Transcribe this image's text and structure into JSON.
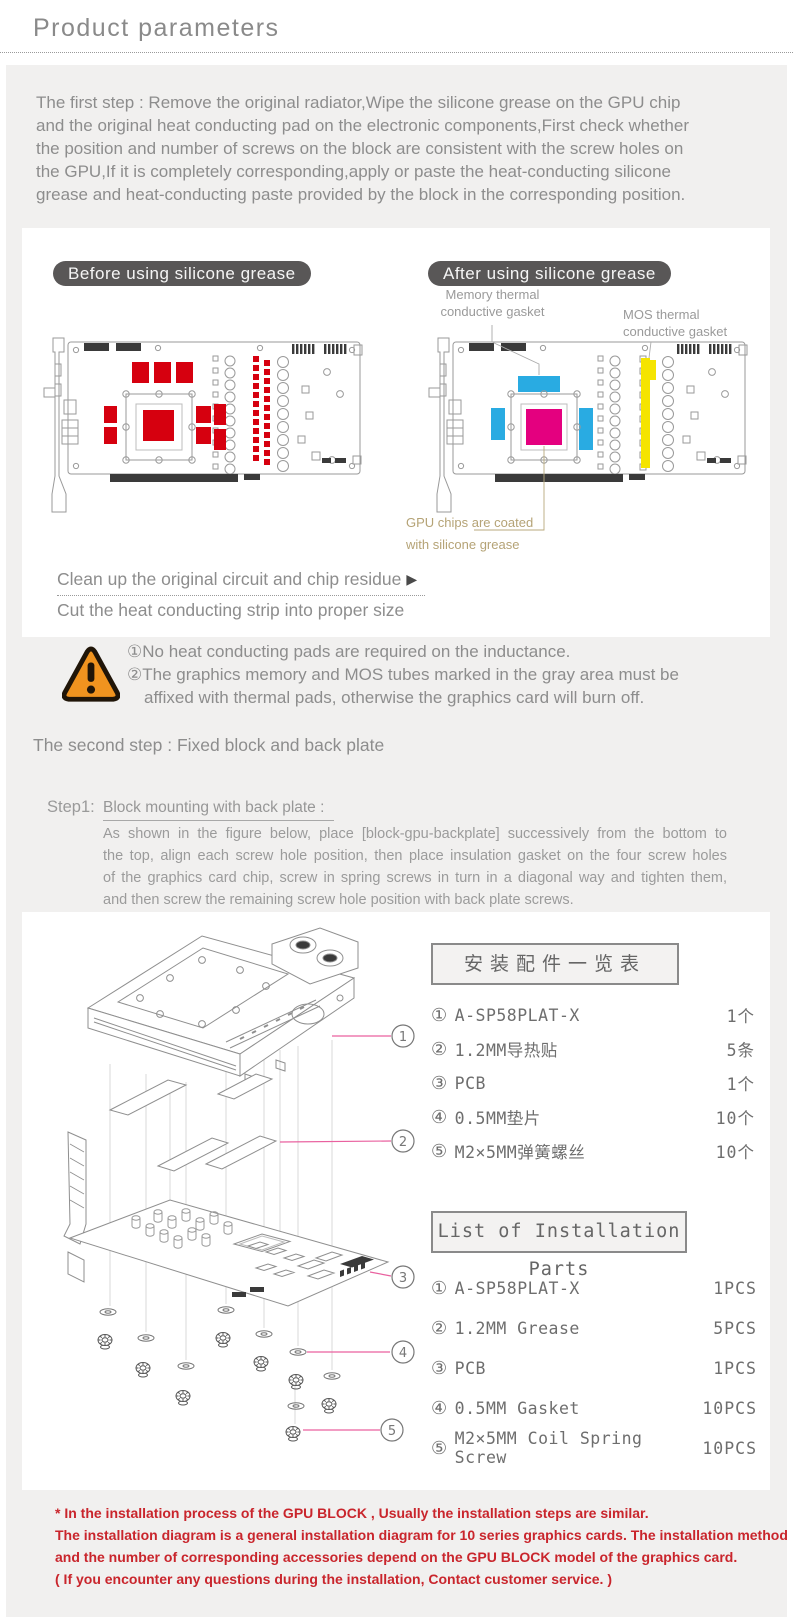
{
  "page": {
    "title": "Product parameters"
  },
  "intro": {
    "lines": [
      "The first step : Remove the original radiator,Wipe the silicone grease on the GPU chip",
      "and the original heat conducting pad on the electronic components,First check whether",
      "the position and number of screws on the block are consistent with the screw holes on",
      "the GPU,If it is completely corresponding,apply or paste the heat-conducting silicone",
      "grease and heat-conducting paste provided by the block in the corresponding position."
    ]
  },
  "grease_section": {
    "before_label": "Before using silicone grease",
    "after_label": "After using silicone grease",
    "memory_label": "Memory thermal conductive gasket",
    "mos_label": "MOS thermal conductive gasket",
    "gpu_label": "GPU chips are coated with silicone grease",
    "clean_line": "Clean up the original circuit and chip residue",
    "arrow": "▶",
    "cut_line": "Cut the heat conducting strip into proper size"
  },
  "warning": {
    "line1": "①No heat conducting pads are required on the inductance.",
    "line2": "②The graphics memory and MOS tubes marked in the gray area must be",
    "line3": "affixed with thermal pads, otherwise the graphics card will burn off."
  },
  "second_step": {
    "heading": "The second step : Fixed block and back plate",
    "step_label": "Step1:",
    "subheading": "Block mounting with back plate : ",
    "body_lines": [
      "As shown in the figure below, place [block-gpu-backplate] successively from the bottom to",
      "the top, align each screw hole position, then place insulation gasket on the four screw holes",
      "of the graphics card chip, screw in spring screws in turn in a diagonal way and tighten them,",
      "and then screw the remaining screw hole position with back plate screws."
    ]
  },
  "callouts": [
    "1",
    "2",
    "3",
    "4",
    "5"
  ],
  "parts_tables": {
    "cn": {
      "title": "安装配件一览表",
      "rows": [
        {
          "num": "①",
          "label": "A-SP58PLAT-X",
          "qty": "1个"
        },
        {
          "num": "②",
          "label": "1.2MM导热贴",
          "qty": "5条"
        },
        {
          "num": "③",
          "label": "PCB",
          "qty": "1个"
        },
        {
          "num": "④",
          "label": "0.5MM垫片",
          "qty": "10个"
        },
        {
          "num": "⑤",
          "label": "M2×5MM弹簧螺丝",
          "qty": "10个"
        }
      ]
    },
    "en": {
      "title": "List of Installation Parts",
      "rows": [
        {
          "num": "①",
          "label": "A-SP58PLAT-X",
          "qty": "1PCS"
        },
        {
          "num": "②",
          "label": "1.2MM Grease",
          "qty": "5PCS"
        },
        {
          "num": "③",
          "label": "PCB",
          "qty": "1PCS"
        },
        {
          "num": "④",
          "label": "0.5MM Gasket",
          "qty": "10PCS"
        },
        {
          "num": "⑤",
          "label": "M2×5MM Coil Spring Screw",
          "qty": "10PCS"
        }
      ]
    }
  },
  "footnote": {
    "lines": [
      "* In the installation process of the GPU BLOCK , Usually the installation steps are similar.",
      "The installation diagram is a general installation diagram for 10 series graphics cards. The installation method",
      "and the number of corresponding accessories depend on the GPU BLOCK model of the graphics card.",
      "( If you encounter any questions during the installation, Contact customer service. )"
    ]
  },
  "colors": {
    "accent_red": "#d6000f",
    "gasket_cyan": "#29abe2",
    "gpu_magenta": "#e4007f",
    "mos_yellow": "#f5e400",
    "callout_pink": "#e9619f",
    "warning_orange": "#f0931f",
    "footnote_red": "#c9252c",
    "label_tan": "#b5a376",
    "pill_gray": "#595757"
  }
}
